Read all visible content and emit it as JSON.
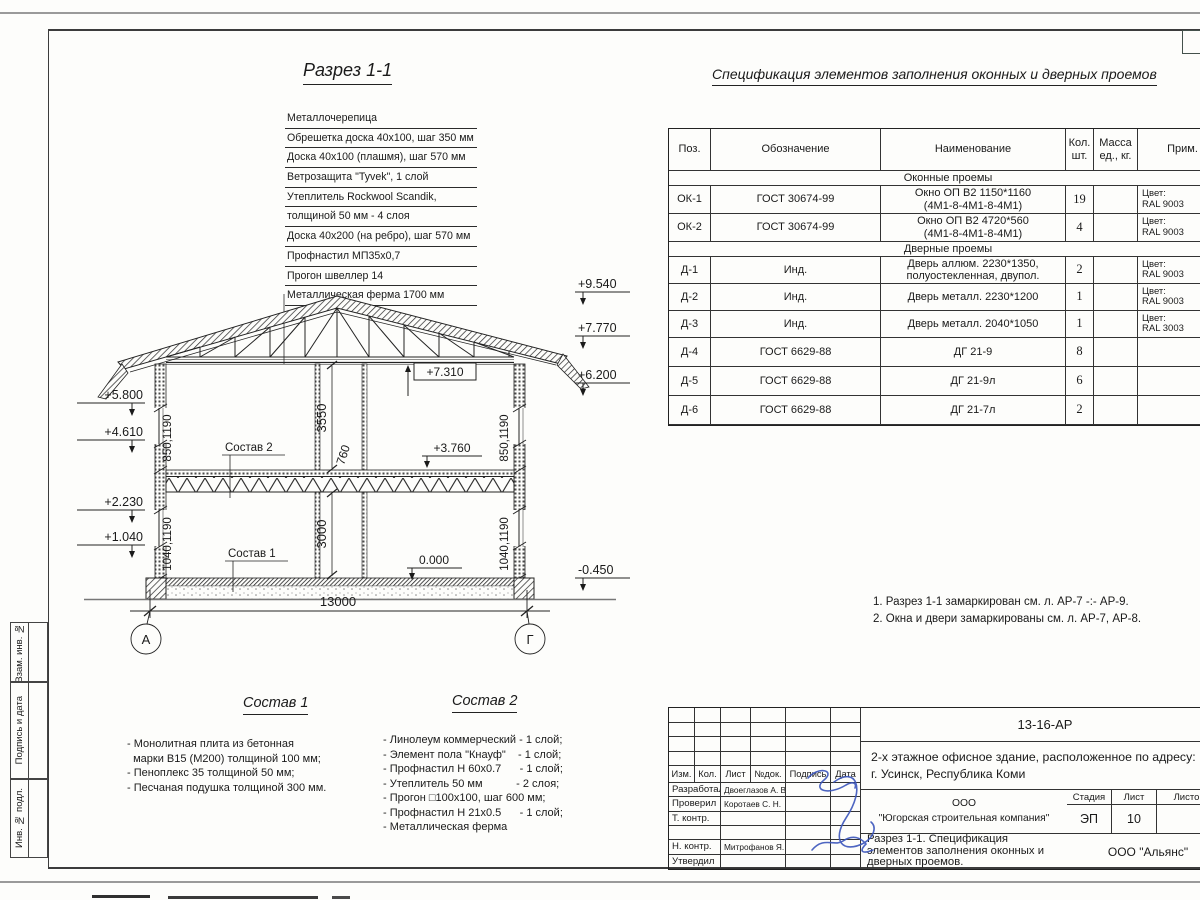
{
  "drawing": {
    "title": "Разрез 1-1",
    "roof_layers": [
      "Металлочерепица",
      "Обрешетка доска 40х100, шаг 350 мм",
      "Доска 40х100 (плашмя), шаг 570 мм",
      "Ветрозащита \"Tyvek\", 1 слой",
      "Утеплитель Rockwool Scandik,",
      "толщиной 50 мм - 4 слоя",
      "Доска 40х200 (на ребро), шаг 570 мм",
      "Профнастил МП35х0,7",
      "Прогон швеллер 14",
      "Металлическая ферма 1700 мм"
    ],
    "elevations": {
      "right_top": "+9.540",
      "right_2": "+7.770",
      "right_3": "+6.200",
      "right_bottom": "-0.450",
      "left_1": "+5.800",
      "left_2": "+4.610",
      "left_3": "+2.230",
      "left_4": "+1.040",
      "inner_ceiling": "+7.310",
      "inner_floor2": "+3.760",
      "inner_floor1": "0.000"
    },
    "dimensions": {
      "span": "13000",
      "floor2_height": "3550",
      "floor_thickness": "760",
      "floor1_height": "3000",
      "wall_upper": "850,1190",
      "wall_lower": "1040,1190"
    },
    "axes": {
      "left": "А",
      "right": "Г"
    },
    "sostav1_ref": "Состав 1",
    "sostav2_ref": "Состав 2"
  },
  "spec_table": {
    "title": "Спецификация элементов заполнения оконных и дверных проемов",
    "headers": {
      "pos": "Поз.",
      "doc": "Обозначение",
      "name": "Наименование",
      "qty": "Кол.\nшт.",
      "mass": "Масса\nед., кг.",
      "note": "Прим."
    },
    "section_windows": "Оконные проемы",
    "section_doors": "Дверные проемы",
    "rows": [
      {
        "pos": "ОК-1",
        "doc": "ГОСТ 30674-99",
        "name": "Окно ОП В2 1150*1160\n(4М1-8-4М1-8-4М1)",
        "qty": "19",
        "mass": "",
        "note": "Цвет:\nRAL 9003"
      },
      {
        "pos": "ОК-2",
        "doc": "ГОСТ 30674-99",
        "name": "Окно ОП В2 4720*560\n(4М1-8-4М1-8-4М1)",
        "qty": "4",
        "mass": "",
        "note": "Цвет:\nRAL 9003"
      },
      {
        "pos": "Д-1",
        "doc": "Инд.",
        "name": "Дверь аллюм. 2230*1350,\nполуостекленная, двупол.",
        "qty": "2",
        "mass": "",
        "note": "Цвет:\nRAL 9003"
      },
      {
        "pos": "Д-2",
        "doc": "Инд.",
        "name": "Дверь металл. 2230*1200",
        "qty": "1",
        "mass": "",
        "note": "Цвет:\nRAL 9003"
      },
      {
        "pos": "Д-3",
        "doc": "Инд.",
        "name": "Дверь металл. 2040*1050",
        "qty": "1",
        "mass": "",
        "note": "Цвет:\nRAL 3003"
      },
      {
        "pos": "Д-4",
        "doc": "ГОСТ 6629-88",
        "name": "ДГ 21-9",
        "qty": "8",
        "mass": "",
        "note": ""
      },
      {
        "pos": "Д-5",
        "doc": "ГОСТ 6629-88",
        "name": "ДГ 21-9л",
        "qty": "6",
        "mass": "",
        "note": ""
      },
      {
        "pos": "Д-6",
        "doc": "ГОСТ 6629-88",
        "name": "ДГ 21-7л",
        "qty": "2",
        "mass": "",
        "note": ""
      }
    ]
  },
  "notes": {
    "n1": "1. Разрез 1-1 замаркирован см. л. АР-7 -:- АР-9.",
    "n2": "2. Окна и двери замаркированы см. л. АР-7, АР-8."
  },
  "compositions": {
    "c1_title": "Состав 1",
    "c1_items": "- Монолитная плита из бетонная\n  марки В15 (М200) толщиной 100 мм;\n- Пеноплекс 35 толщиной 50 мм;\n- Песчаная подушка толщиной 300 мм.",
    "c2_title": "Состав 2",
    "c2_items": "- Линолеум коммерческий - 1 слой;\n- Элемент пола \"Кнауф\"    - 1 слой;\n- Профнастил Н 60х0.7      - 1 слой;\n- Утеплитель 50 мм           - 2 слоя;\n- Прогон □100х100, шаг 600 мм;\n- Профнастил Н 21х0.5      - 1 слой;\n- Металлическая ферма"
  },
  "stamp": {
    "doc_number": "13-16-АР",
    "project": "2-х этажное офисное здание, расположенное по адресу:\nг. Усинск, Республика Коми",
    "organization": "ООО\n\"Югорская строительная компания\"",
    "sheet_title": "Разрез 1-1. Спецификация\nэлементов заполнения оконных и\nдверных проемов.",
    "contractor": "ООО \"Альянс\"",
    "stage_label": "Стадия",
    "stage_value": "ЭП",
    "sheet_label": "Лист",
    "sheet_value": "10",
    "sheets_label": "Листов",
    "header_cols": {
      "c1": "Изм.",
      "c2": "Кол.",
      "c3": "Лист",
      "c4": "№док.",
      "c5": "Подпись",
      "c6": "Дата"
    },
    "roles": [
      {
        "role": "Разработал",
        "name": "Двоеглазов А. В."
      },
      {
        "role": "Проверил",
        "name": "Коротаев С. Н."
      },
      {
        "role": "Т. контр.",
        "name": ""
      },
      {
        "role": "",
        "name": ""
      },
      {
        "role": "Н. контр.",
        "name": "Митрофанов Я. А."
      },
      {
        "role": "Утвердил",
        "name": ""
      }
    ]
  },
  "side_labels": {
    "l1": "Взам. инв. №",
    "l2": "Подпись и дата",
    "l3": "Инв. № подл."
  },
  "colors": {
    "ink": "#1a1a1a",
    "signature_blue": "#3b55bb",
    "scan_gray": "#9a9a9a"
  }
}
